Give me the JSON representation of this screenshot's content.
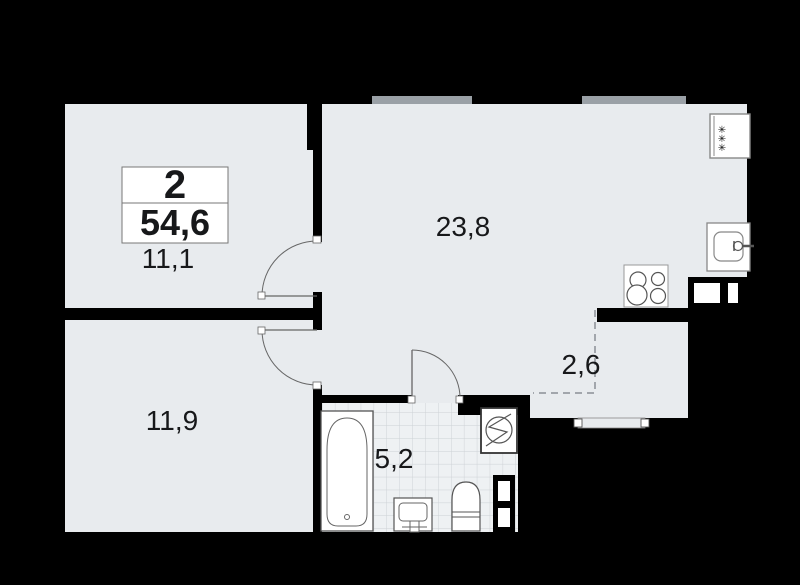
{
  "unit_summary": {
    "rooms_count": "2",
    "total_area": "54,6"
  },
  "rooms": [
    {
      "name": "bedroom-top",
      "area": "11,1"
    },
    {
      "name": "living-kitchen",
      "area": "23,8"
    },
    {
      "name": "bedroom-bottom",
      "area": "11,9"
    },
    {
      "name": "storage-niche",
      "area": "2,6"
    },
    {
      "name": "bathroom",
      "area": "5,2"
    }
  ],
  "fixtures": {
    "vent_glyph": "✳",
    "icons": [
      "bathtub-icon",
      "bath-sink-icon",
      "toilet-icon",
      "washing-machine-icon",
      "duct-shaft-icon",
      "stove-icon",
      "kitchen-sink-icon",
      "vent-icon"
    ]
  },
  "colors": {
    "background": "#000000",
    "floor": "#e8ebee",
    "wall": "#000000",
    "window": "#9aa0a6",
    "tile_line": "#ccd1d5",
    "tile_floor": "#eef1f3",
    "fixture_line": "#555555",
    "dash_line": "#8a9096",
    "text": "#17181a"
  }
}
